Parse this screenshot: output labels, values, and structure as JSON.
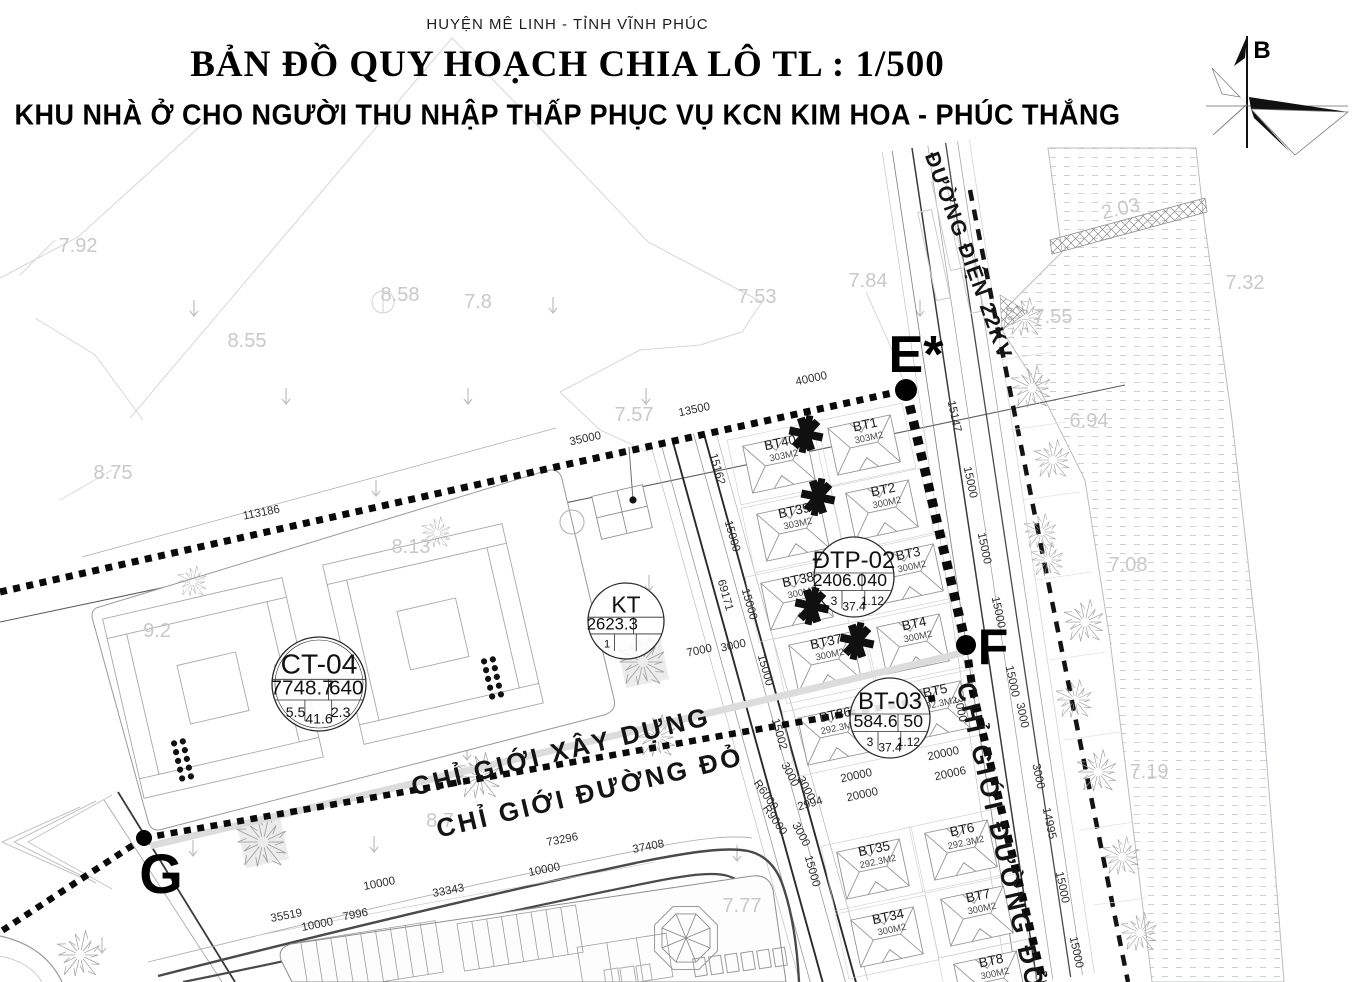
{
  "header": {
    "district": "HUYỆN MÊ LINH - TỈNH VĨNH PHÚC",
    "title": "BẢN ĐỒ QUY HOẠCH CHIA LÔ TL : 1/500",
    "subtitle": "KHU NHÀ Ở CHO NGƯỜI THU NHẬP THẤP PHỤC VỤ KCN KIM HOA - PHÚC THẮNG"
  },
  "north": {
    "label": "B"
  },
  "colors": {
    "ink": "#0a0a0a",
    "dim_text": "#2e2e2e",
    "elev_text": "#c9c9c9",
    "line_light": "#d7d7d7"
  },
  "road_labels": [
    {
      "id": "duong-dien-22kv",
      "text": "ĐƯỜNG ĐIỆN 22KV",
      "x": 962,
      "y": 258,
      "rot": 70,
      "size": 21,
      "ls": 1.5
    },
    {
      "id": "chi-gioi-xay-dung",
      "text": "CHỈ GIỚI XÂY DỰNG",
      "x": 563,
      "y": 760,
      "rot": -13.5,
      "size": 26,
      "ls": 3
    },
    {
      "id": "chi-gioi-duong-do",
      "text": "CHỈ GIỚI ĐƯỜNG ĐỎ",
      "x": 592,
      "y": 801,
      "rot": -13.5,
      "size": 26,
      "ls": 3
    },
    {
      "id": "chi-gioi-duong-do-right",
      "text": "CHỈ GIỚI ĐƯỜNG ĐỎ",
      "x": 992,
      "y": 838,
      "rot": 77,
      "size": 26,
      "ls": 3
    }
  ],
  "markers": [
    {
      "label": "E*",
      "tx": 916,
      "ty": 372,
      "size": 52,
      "dot": [
        906,
        390,
        11
      ]
    },
    {
      "label": "F",
      "tx": 993,
      "ty": 664,
      "size": 50,
      "dot": [
        966,
        645,
        10
      ]
    },
    {
      "label": "G",
      "tx": 161,
      "ty": 893,
      "size": 56,
      "dot": [
        144,
        838,
        8
      ]
    }
  ],
  "info_circles": [
    {
      "name": "CT-04",
      "cx": 319,
      "cy": 684,
      "r": 47,
      "double_ring": true,
      "row2": [
        "7748.7",
        "640"
      ],
      "row3": [
        "5.5",
        "41.6",
        "2.3"
      ]
    },
    {
      "name": "KT",
      "cx": 626,
      "cy": 621,
      "r": 38,
      "double_ring": false,
      "row2": [
        "2623.3",
        ""
      ],
      "row3": [
        "1",
        "",
        ""
      ]
    },
    {
      "name": "ĐTP-02",
      "cx": 854,
      "cy": 577,
      "r": 40,
      "double_ring": false,
      "row2": [
        "2406.0",
        "40"
      ],
      "row3": [
        "3",
        "37.4",
        "1.12"
      ]
    },
    {
      "name": "BT-03",
      "cx": 890,
      "cy": 718,
      "r": 40,
      "double_ring": false,
      "row2": [
        "584.6",
        "50"
      ],
      "row3": [
        "3",
        "37.4",
        "1.12"
      ]
    }
  ],
  "lots": [
    {
      "id": "BT1",
      "area": "303M2",
      "x": 866,
      "y": 429
    },
    {
      "id": "BT2",
      "area": "300M2",
      "x": 884,
      "y": 494
    },
    {
      "id": "BT3",
      "area": "300M2",
      "x": 909,
      "y": 558
    },
    {
      "id": "BT4",
      "area": "300M2",
      "x": 915,
      "y": 628
    },
    {
      "id": "BT5",
      "area": "292.3M2",
      "x": 936,
      "y": 695
    },
    {
      "id": "BT6",
      "area": "292.3M2",
      "x": 963,
      "y": 834
    },
    {
      "id": "BT7",
      "area": "300M2",
      "x": 979,
      "y": 900
    },
    {
      "id": "BT8",
      "area": "300M2",
      "x": 992,
      "y": 965
    },
    {
      "id": "BT34",
      "area": "300M2",
      "x": 889,
      "y": 921
    },
    {
      "id": "BT35",
      "area": "292.3M2",
      "x": 875,
      "y": 853
    },
    {
      "id": "BT36",
      "area": "292.3M2",
      "x": 836,
      "y": 719
    },
    {
      "id": "BT37",
      "area": "300M2",
      "x": 827,
      "y": 646
    },
    {
      "id": "BT38",
      "area": "300M2",
      "x": 799,
      "y": 584
    },
    {
      "id": "BT39",
      "area": "303M2",
      "x": 795,
      "y": 515
    },
    {
      "id": "BT40",
      "area": "303M2",
      "x": 781,
      "y": 447
    }
  ],
  "dims": [
    {
      "t": "35000",
      "x": 586,
      "y": 442,
      "r": -12
    },
    {
      "t": "13500",
      "x": 695,
      "y": 413,
      "r": -12
    },
    {
      "t": "40000",
      "x": 812,
      "y": 382,
      "r": -12
    },
    {
      "t": "113186",
      "x": 262,
      "y": 516,
      "r": -11
    },
    {
      "t": "15147",
      "x": 951,
      "y": 417,
      "r": 78
    },
    {
      "t": "15000",
      "x": 967,
      "y": 483,
      "r": 78
    },
    {
      "t": "15000",
      "x": 981,
      "y": 549,
      "r": 78
    },
    {
      "t": "15000",
      "x": 995,
      "y": 613,
      "r": 78
    },
    {
      "t": "3000",
      "x": 1019,
      "y": 716,
      "r": 78
    },
    {
      "t": "3000",
      "x": 1035,
      "y": 777,
      "r": 78
    },
    {
      "t": "14995",
      "x": 1046,
      "y": 824,
      "r": 78
    },
    {
      "t": "15000",
      "x": 1059,
      "y": 888,
      "r": 78
    },
    {
      "t": "15000",
      "x": 1073,
      "y": 953,
      "r": 78
    },
    {
      "t": "15000",
      "x": 1009,
      "y": 682,
      "r": 78
    },
    {
      "t": "3000",
      "x": 957,
      "y": 710,
      "r": 78
    },
    {
      "t": "15162",
      "x": 714,
      "y": 470,
      "r": 74
    },
    {
      "t": "15000",
      "x": 729,
      "y": 537,
      "r": 74
    },
    {
      "t": "69171",
      "x": 722,
      "y": 596,
      "r": 74
    },
    {
      "t": "15000",
      "x": 746,
      "y": 605,
      "r": 74
    },
    {
      "t": "15000",
      "x": 762,
      "y": 671,
      "r": 74
    },
    {
      "t": "15002",
      "x": 776,
      "y": 735,
      "r": 74
    },
    {
      "t": "15000",
      "x": 809,
      "y": 872,
      "r": 74
    },
    {
      "t": "7000",
      "x": 700,
      "y": 654,
      "r": -12
    },
    {
      "t": "3000",
      "x": 734,
      "y": 649,
      "r": -12
    },
    {
      "t": "20000",
      "x": 857,
      "y": 779,
      "r": -12
    },
    {
      "t": "20000",
      "x": 863,
      "y": 798,
      "r": -12
    },
    {
      "t": "20000",
      "x": 944,
      "y": 757,
      "r": -12
    },
    {
      "t": "20006",
      "x": 951,
      "y": 777,
      "r": -12
    },
    {
      "t": "2994",
      "x": 811,
      "y": 807,
      "r": -16
    },
    {
      "t": "3000",
      "x": 787,
      "y": 776,
      "r": 62
    },
    {
      "t": "3000",
      "x": 803,
      "y": 790,
      "r": 62
    },
    {
      "t": "3000",
      "x": 798,
      "y": 836,
      "r": 62
    },
    {
      "t": "R6000",
      "x": 763,
      "y": 797,
      "r": 55
    },
    {
      "t": "R9000",
      "x": 772,
      "y": 822,
      "r": 55
    },
    {
      "t": "73296",
      "x": 563,
      "y": 843,
      "r": -11
    },
    {
      "t": "37408",
      "x": 649,
      "y": 850,
      "r": -11
    },
    {
      "t": "10000",
      "x": 545,
      "y": 873,
      "r": -11
    },
    {
      "t": "10000",
      "x": 380,
      "y": 887,
      "r": -11
    },
    {
      "t": "33343",
      "x": 449,
      "y": 894,
      "r": -11
    },
    {
      "t": "35519",
      "x": 287,
      "y": 919,
      "r": -11
    },
    {
      "t": "10000",
      "x": 318,
      "y": 928,
      "r": -11
    },
    {
      "t": "7996",
      "x": 356,
      "y": 918,
      "r": -11
    }
  ],
  "elevations": [
    {
      "t": "7.92",
      "x": 78,
      "y": 252
    },
    {
      "t": "8.58",
      "x": 400,
      "y": 301
    },
    {
      "t": "7.8",
      "x": 478,
      "y": 308
    },
    {
      "t": "8.55",
      "x": 247,
      "y": 347
    },
    {
      "t": "7.53",
      "x": 757,
      "y": 303
    },
    {
      "t": "7.57",
      "x": 634,
      "y": 421
    },
    {
      "t": "7.84",
      "x": 868,
      "y": 287
    },
    {
      "t": "8.75",
      "x": 113,
      "y": 479
    },
    {
      "t": "9.2",
      "x": 157,
      "y": 637
    },
    {
      "t": "8.13",
      "x": 411,
      "y": 553
    },
    {
      "t": "8.86",
      "x": 292,
      "y": 677
    },
    {
      "t": "2.03",
      "x": 1122,
      "y": 215,
      "r": -13
    },
    {
      "t": "7.32",
      "x": 1245,
      "y": 289
    },
    {
      "t": "7.55",
      "x": 1053,
      "y": 323
    },
    {
      "t": "6.94",
      "x": 1089,
      "y": 427
    },
    {
      "t": "7.08",
      "x": 1128,
      "y": 571
    },
    {
      "t": "7.19",
      "x": 1149,
      "y": 778
    },
    {
      "t": "8.7",
      "x": 440,
      "y": 827
    },
    {
      "t": "7.77",
      "x": 742,
      "y": 912
    }
  ],
  "asterisks": [
    [
      806,
      434
    ],
    [
      818,
      497
    ],
    [
      812,
      606
    ],
    [
      857,
      641
    ]
  ]
}
